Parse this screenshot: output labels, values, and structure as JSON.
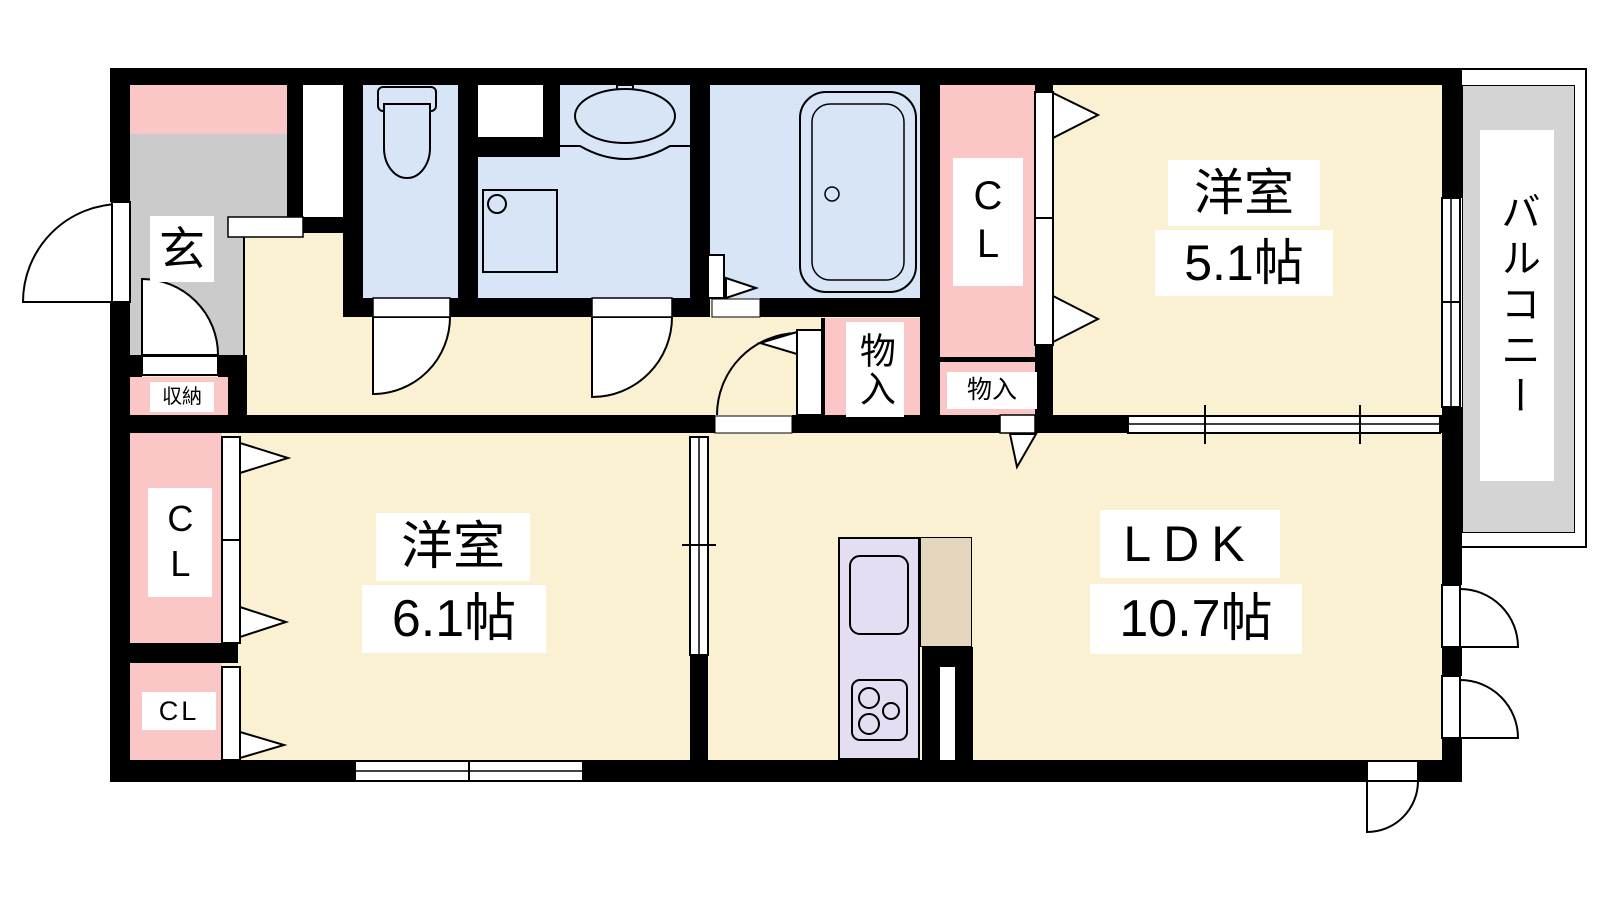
{
  "title": "間取り図 (apartment floor plan)",
  "rooms": {
    "entrance": {
      "label": "玄"
    },
    "entrance_storage": {
      "label": "収納"
    },
    "hall_closet": {
      "label": "CL"
    },
    "storage_tall": {
      "label": "物入"
    },
    "storage_small": {
      "label": "物入"
    },
    "western_room_a": {
      "name": "洋室",
      "size": "5.1帖"
    },
    "western_room_b": {
      "name": "洋室",
      "size": "6.1帖"
    },
    "ldk": {
      "name": "LDK",
      "size": "10.7帖"
    },
    "balcony": {
      "label": "バルコニー"
    },
    "bedroom_closet_upper": {
      "label": "CL"
    },
    "bedroom_closet_lower": {
      "label": "CL"
    }
  },
  "icons": {
    "toilet": "toilet-icon",
    "washbasin": "washbasin-icon",
    "washing_machine_pan": "washing-machine-pan-icon",
    "bathtub": "bathtub-icon",
    "kitchen_sink": "kitchen-sink-icon",
    "stove": "stove-icon"
  },
  "colors": {
    "wall": "#000000",
    "floor": "#FAF0D2",
    "wet": "#D7E5F7",
    "closet": "#FAC6C6",
    "entrance": "#CBCBCB",
    "balcony": "#D4D4D4",
    "kitchen": "#E5DEF2",
    "appliance": "#E3D6BD"
  }
}
